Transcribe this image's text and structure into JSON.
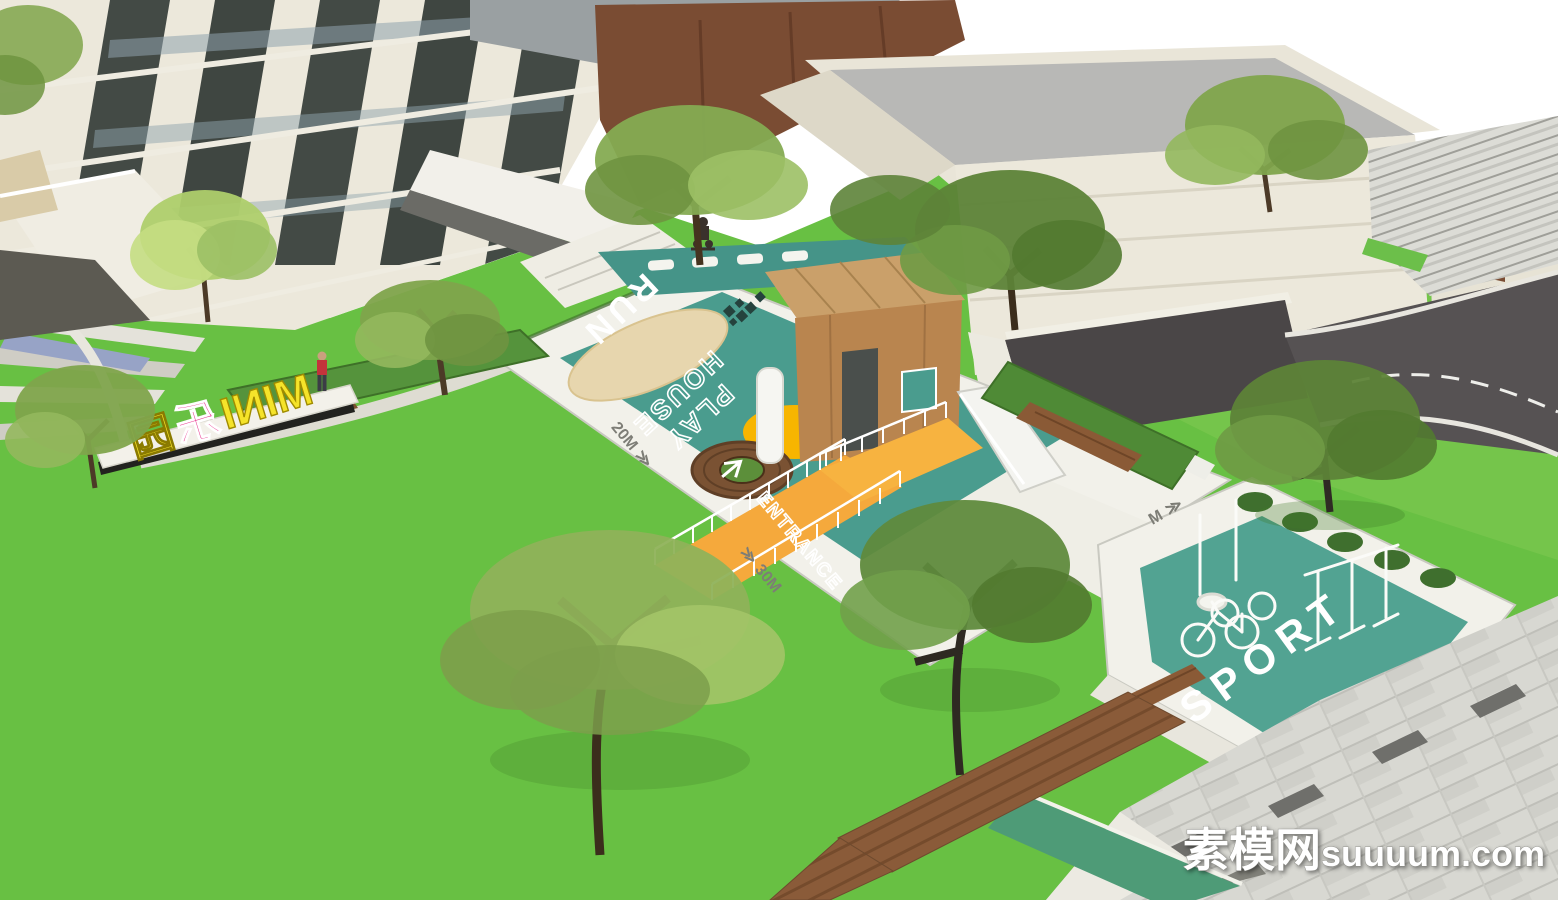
{
  "labels": {
    "run": "RUN",
    "house_line1": "PLAY",
    "house_line2": "HOUSE",
    "entrance": "ENTRANCE",
    "sport": "SPORT",
    "mark_20m": "20M",
    "mark_30m": "30M",
    "mark_partial": "M",
    "chevrons": "≫"
  },
  "sign": {
    "word_mini": "MINI",
    "char_le": "乐",
    "char_yuan": "园"
  },
  "watermark": {
    "site_name_cn": "素模网",
    "site_domain": "suuuum.com"
  },
  "colors": {
    "playground_teal": "#4a9c8e",
    "sport_teal": "#52a392",
    "lawn_green": "#68c043",
    "accent_yellow": "#f7b500",
    "ramp_orange": "#f5a93c",
    "sign_pink": "#e8368f",
    "sign_yellow": "#f5e32a",
    "wood_brown": "#b9854f",
    "building_cream": "#ece8db",
    "roof_gray": "#b8b8b6",
    "corten_brown": "#7a4c33",
    "road_asphalt": "#565253"
  }
}
